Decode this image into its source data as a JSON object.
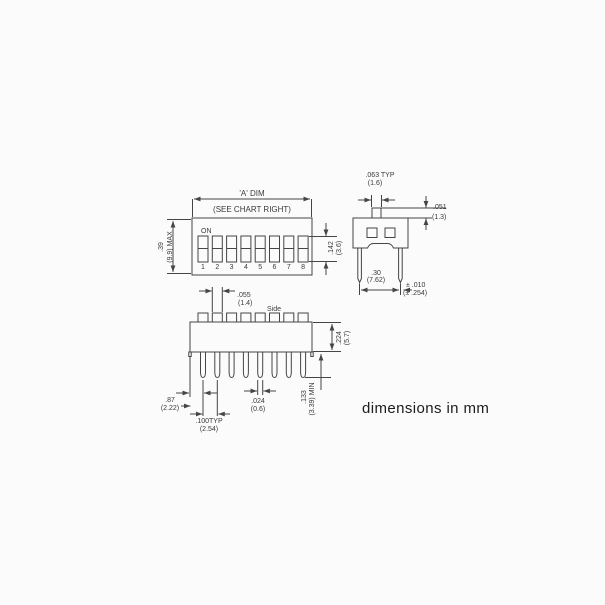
{
  "note": "dimensions in mm",
  "colors": {
    "line": "#454545",
    "text": "#3a3a3a",
    "background": "#fbfbfb"
  },
  "top_view": {
    "width_dim_label": "'A' DIM",
    "width_dim_sublabel": "(SEE CHART RIGHT)",
    "on_label": "ON",
    "positions": [
      "1",
      "2",
      "3",
      "4",
      "5",
      "6",
      "7",
      "8"
    ],
    "height_dim": {
      "in": ".39",
      "mm": "(9.9) MAX"
    },
    "slot_height_dim": {
      "in": ".142",
      "mm": "(3.6)"
    }
  },
  "end_view": {
    "actuator_width_dim": {
      "in": ".063 TYP",
      "mm": "(1.6)"
    },
    "actuator_height_dim": {
      "in": ".051",
      "mm": "(1.3)"
    },
    "pin_span_dim": {
      "in": ".30",
      "mm": "(7.62)"
    },
    "pin_span_tolerance": {
      "in": "± .010",
      "mm": "(± .254)"
    }
  },
  "side_view": {
    "label": "Side",
    "actuator_width_dim": {
      "in": ".055",
      "mm": "(1.4)"
    },
    "body_height_dim": {
      "in": ".224",
      "mm": "(5.7)"
    },
    "pin_length_dim": {
      "in": ".133",
      "mm": "(3.39) MIN"
    },
    "first_pin_dim": {
      "in": ".87",
      "mm": "(2.22)"
    },
    "pin_pitch_dim": {
      "in": ".100TYP",
      "mm": "(2.54)"
    },
    "pin_width_dim": {
      "in": ".024",
      "mm": "(0.6)"
    }
  }
}
